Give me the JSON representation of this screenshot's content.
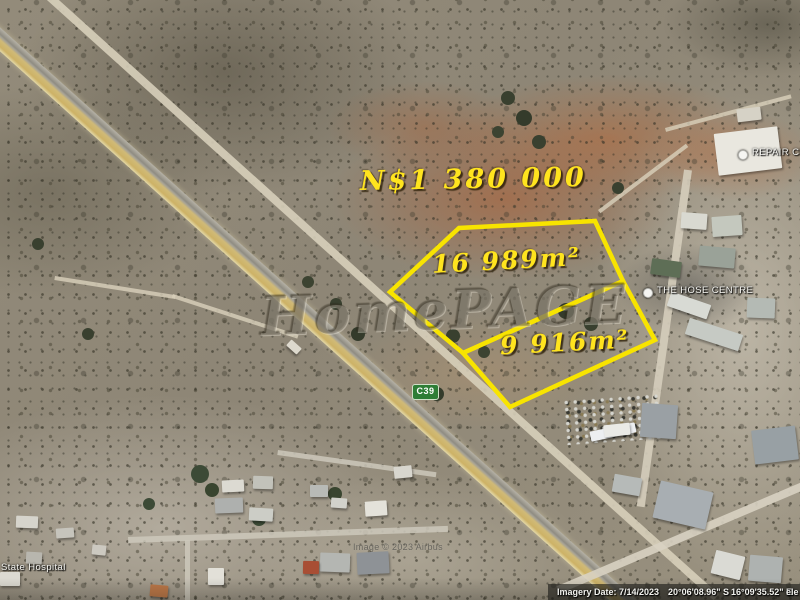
{
  "listing": {
    "price": "N$1 380 000",
    "outline_color": "#f8e400",
    "parcels": [
      {
        "id": "parcel-16989",
        "area_label": "16 989m²",
        "points": "390,292 459,228 595,221 623,281 463,353"
      },
      {
        "id": "parcel-9916",
        "area_label": "9 916m²",
        "points": "463,353 623,281 655,340 510,407"
      }
    ]
  },
  "watermark": {
    "text": "HomePAGE"
  },
  "poi": {
    "hose_centre": "THE HOSE CENTRE",
    "repair_centre": "REPAIR CENT",
    "state_hospital": "State Hospital"
  },
  "roads": {
    "shield": "C39"
  },
  "attribution": {
    "imagery_provider": "Image © 2023 Airbus"
  },
  "status_bar": {
    "imagery_date": "Imagery Date: 7/14/2023",
    "latitude": "20°06'08.96\" S",
    "longitude": "16°09'35.52\" E",
    "elevation_partial": "ele"
  }
}
